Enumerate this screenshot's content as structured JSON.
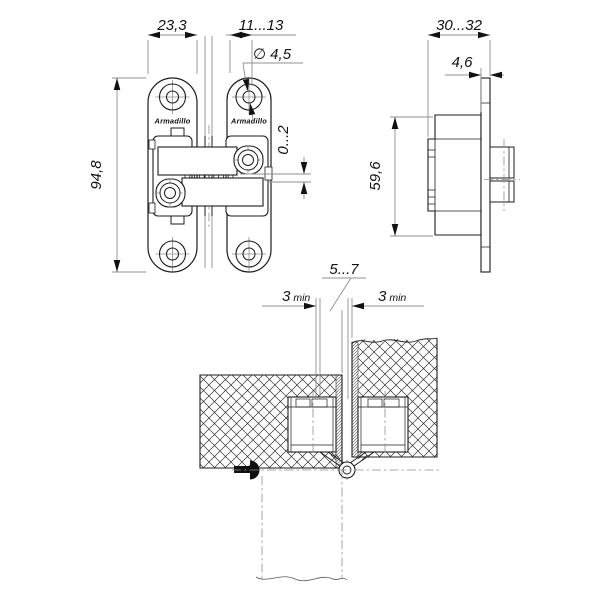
{
  "meta": {
    "background": "#ffffff",
    "line_color": "#1c1c1c",
    "dim_line_color": "#8f8f8f",
    "text_color": "#111111"
  },
  "brand": {
    "label": "Armadillo"
  },
  "dims": {
    "front": {
      "plate_pitch": "23,3",
      "edge_to_axis": "11...13",
      "hole_diameter": "∅ 4,5",
      "overall_height": "94,8",
      "adjustment_range": "0...2"
    },
    "side": {
      "mortise_depth": "30...32",
      "plate_thickness": "4,6",
      "body_height": "59,6"
    },
    "section": {
      "gap": "5...7",
      "left_min_value": "3",
      "left_min_unit": "min",
      "right_min_value": "3",
      "right_min_unit": "min"
    }
  }
}
